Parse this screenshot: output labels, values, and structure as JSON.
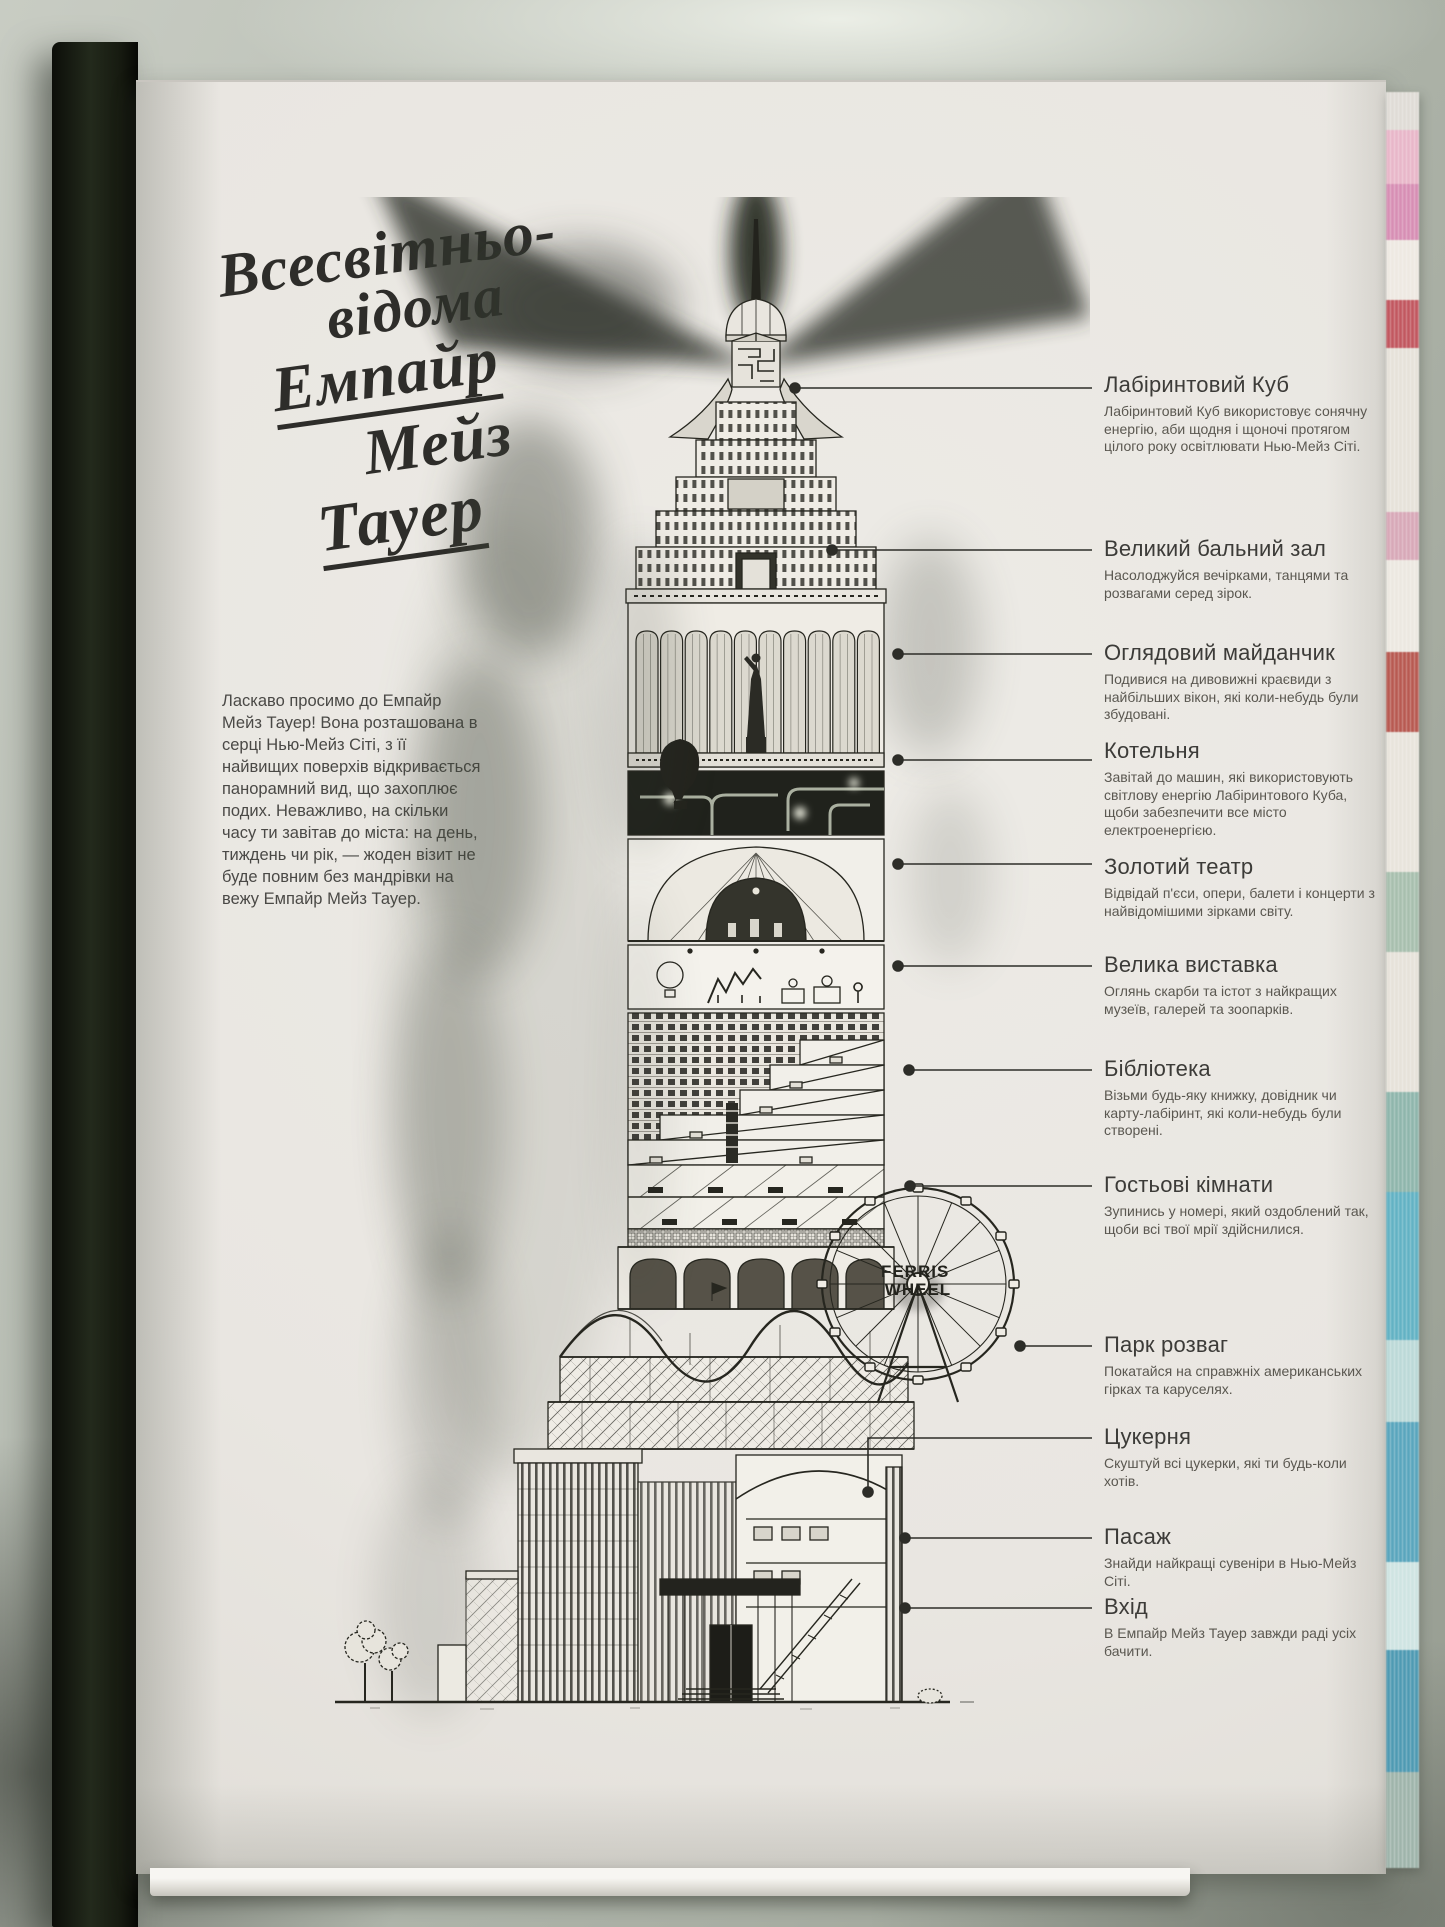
{
  "title": {
    "lines": [
      "Всесвітньо-",
      "відома",
      "Емпайр",
      "Мейз",
      "Тауер"
    ]
  },
  "intro": {
    "text": "Ласкаво просимо до Емпайр Мейз Тауер! Вона розташована в серці Нью-Мейз Сіті, з її найвищих поверхів відкривається панорамний вид, що захоплює подих. Неважливо, на скільки часу ти завітав до міста: на день, тиждень чи рік, — жоден візит не буде повним без мандрівки на вежу Емпайр Мейз Тауер."
  },
  "callouts": [
    {
      "title": "Лабіринтовий Куб",
      "desc": "Лабіринтовий Куб використовує сонячну енергію, аби щодня і щоночі протягом цілого року освітлювати Нью-Мейз Сіті."
    },
    {
      "title": "Великий бальний зал",
      "desc": "Насолоджуйся вечірками, танцями та розвагами серед зірок."
    },
    {
      "title": "Оглядовий майданчик",
      "desc": "Подивися на дивовижні краєвиди з найбільших вікон, які коли-небудь були збудовані."
    },
    {
      "title": "Котельня",
      "desc": "Завітай до машин, які використовують світлову енергію Лабіринтового Куба, щоби забезпечити все місто електроенергією."
    },
    {
      "title": "Золотий театр",
      "desc": "Відвідай п'єси, опери, балети і концерти з найвідомішими зірками світу."
    },
    {
      "title": "Велика виставка",
      "desc": "Оглянь скарби та істот з найкращих музеїв, галерей та зоопарків."
    },
    {
      "title": "Бібліотека",
      "desc": "Візьми будь-яку книжку, довідник чи карту-лабіринт, які коли-небудь були створені."
    },
    {
      "title": "Гостьові кімнати",
      "desc": "Зупинись у номері, який оздоблений так, щоби всі твої мрії здійснилися."
    },
    {
      "title": "Парк розваг",
      "desc": "Покатайся на справжніх американських гірках та каруселях."
    },
    {
      "title": "Цукерня",
      "desc": "Скуштуй всі цукерки, які ти будь-коли хотів."
    },
    {
      "title": "Пасаж",
      "desc": "Знайди найкращі сувеніри в Нью-Мейз Сіті."
    },
    {
      "title": "Вхід",
      "desc": "В Емпайр Мейз Тауер завжди раді усіх бачити."
    }
  ],
  "illustration": {
    "ferris_sign": {
      "line1": "FERRIS",
      "line2": "WHEEL"
    }
  },
  "colors": {
    "ink": "#26261f",
    "page": "#e9e6e1",
    "desk": "#a8aea3",
    "cover": "#161a10",
    "fore_edge_accents": [
      "#e8b7c9",
      "#c25860",
      "#63b2c4",
      "#4f9ab3"
    ]
  }
}
